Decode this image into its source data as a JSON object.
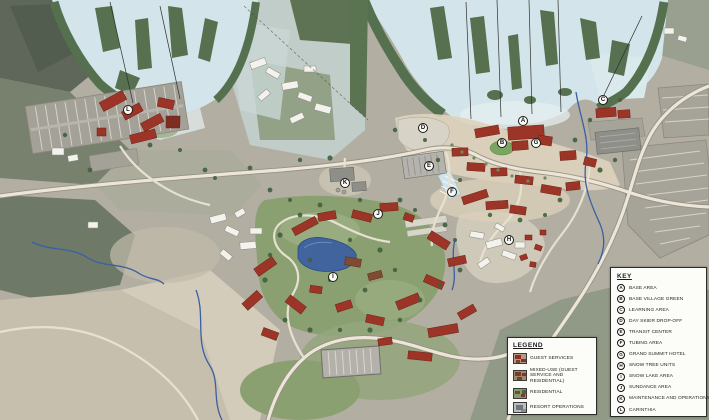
{
  "map": {
    "name": "ski-resort-master-plan",
    "markers": [
      {
        "letter": "A",
        "x": 523,
        "y": 121
      },
      {
        "letter": "B",
        "x": 502,
        "y": 143
      },
      {
        "letter": "C",
        "x": 603,
        "y": 100
      },
      {
        "letter": "D",
        "x": 423,
        "y": 128
      },
      {
        "letter": "E",
        "x": 429,
        "y": 166
      },
      {
        "letter": "F",
        "x": 452,
        "y": 192
      },
      {
        "letter": "G",
        "x": 536,
        "y": 143
      },
      {
        "letter": "H",
        "x": 509,
        "y": 240
      },
      {
        "letter": "I",
        "x": 333,
        "y": 277
      },
      {
        "letter": "J",
        "x": 378,
        "y": 214
      },
      {
        "letter": "K",
        "x": 345,
        "y": 183
      },
      {
        "letter": "L",
        "x": 128,
        "y": 110
      }
    ]
  },
  "legend": {
    "title": "LEGEND",
    "items": [
      {
        "label": "GUEST SERVICES",
        "swatch": "guest-services"
      },
      {
        "label": "MIXED-USE (GUEST SERVICE AND RESIDENTIAL)",
        "swatch": "mixed-use"
      },
      {
        "label": "RESIDENTIAL",
        "swatch": "residential"
      },
      {
        "label": "RESORT OPERATIONS",
        "swatch": "resort-operations"
      }
    ]
  },
  "key": {
    "title": "KEY",
    "items": [
      {
        "letter": "A",
        "label": "BASE AREA"
      },
      {
        "letter": "B",
        "label": "BASE VILLAGE GREEN"
      },
      {
        "letter": "C",
        "label": "LEARNING AREA"
      },
      {
        "letter": "D",
        "label": "DAY SKIER DROP-OFF"
      },
      {
        "letter": "E",
        "label": "TRANSIT CENTER"
      },
      {
        "letter": "F",
        "label": "TUBING AREA"
      },
      {
        "letter": "G",
        "label": "GRAND SUMMIT HOTEL"
      },
      {
        "letter": "H",
        "label": "SNOW TREE UNITS"
      },
      {
        "letter": "I",
        "label": "SNOW LAKE AREA"
      },
      {
        "letter": "J",
        "label": "SUNDANCE AREA"
      },
      {
        "letter": "K",
        "label": "MAINTENANCE AND OPERATIONS"
      },
      {
        "letter": "L",
        "label": "CARINTHIA"
      }
    ]
  },
  "colors": {
    "ski_trail": "#d3e5ea",
    "forest_dark": "#57704f",
    "open_green": "#8ba071",
    "pond_blue": "#41639e",
    "guest_services_red": "#9c3527",
    "resort_operations_gray": "#8f8f8a",
    "road": "#ece6d8",
    "panel_background": "#fcfcf9",
    "panel_border": "#2b2b28"
  }
}
